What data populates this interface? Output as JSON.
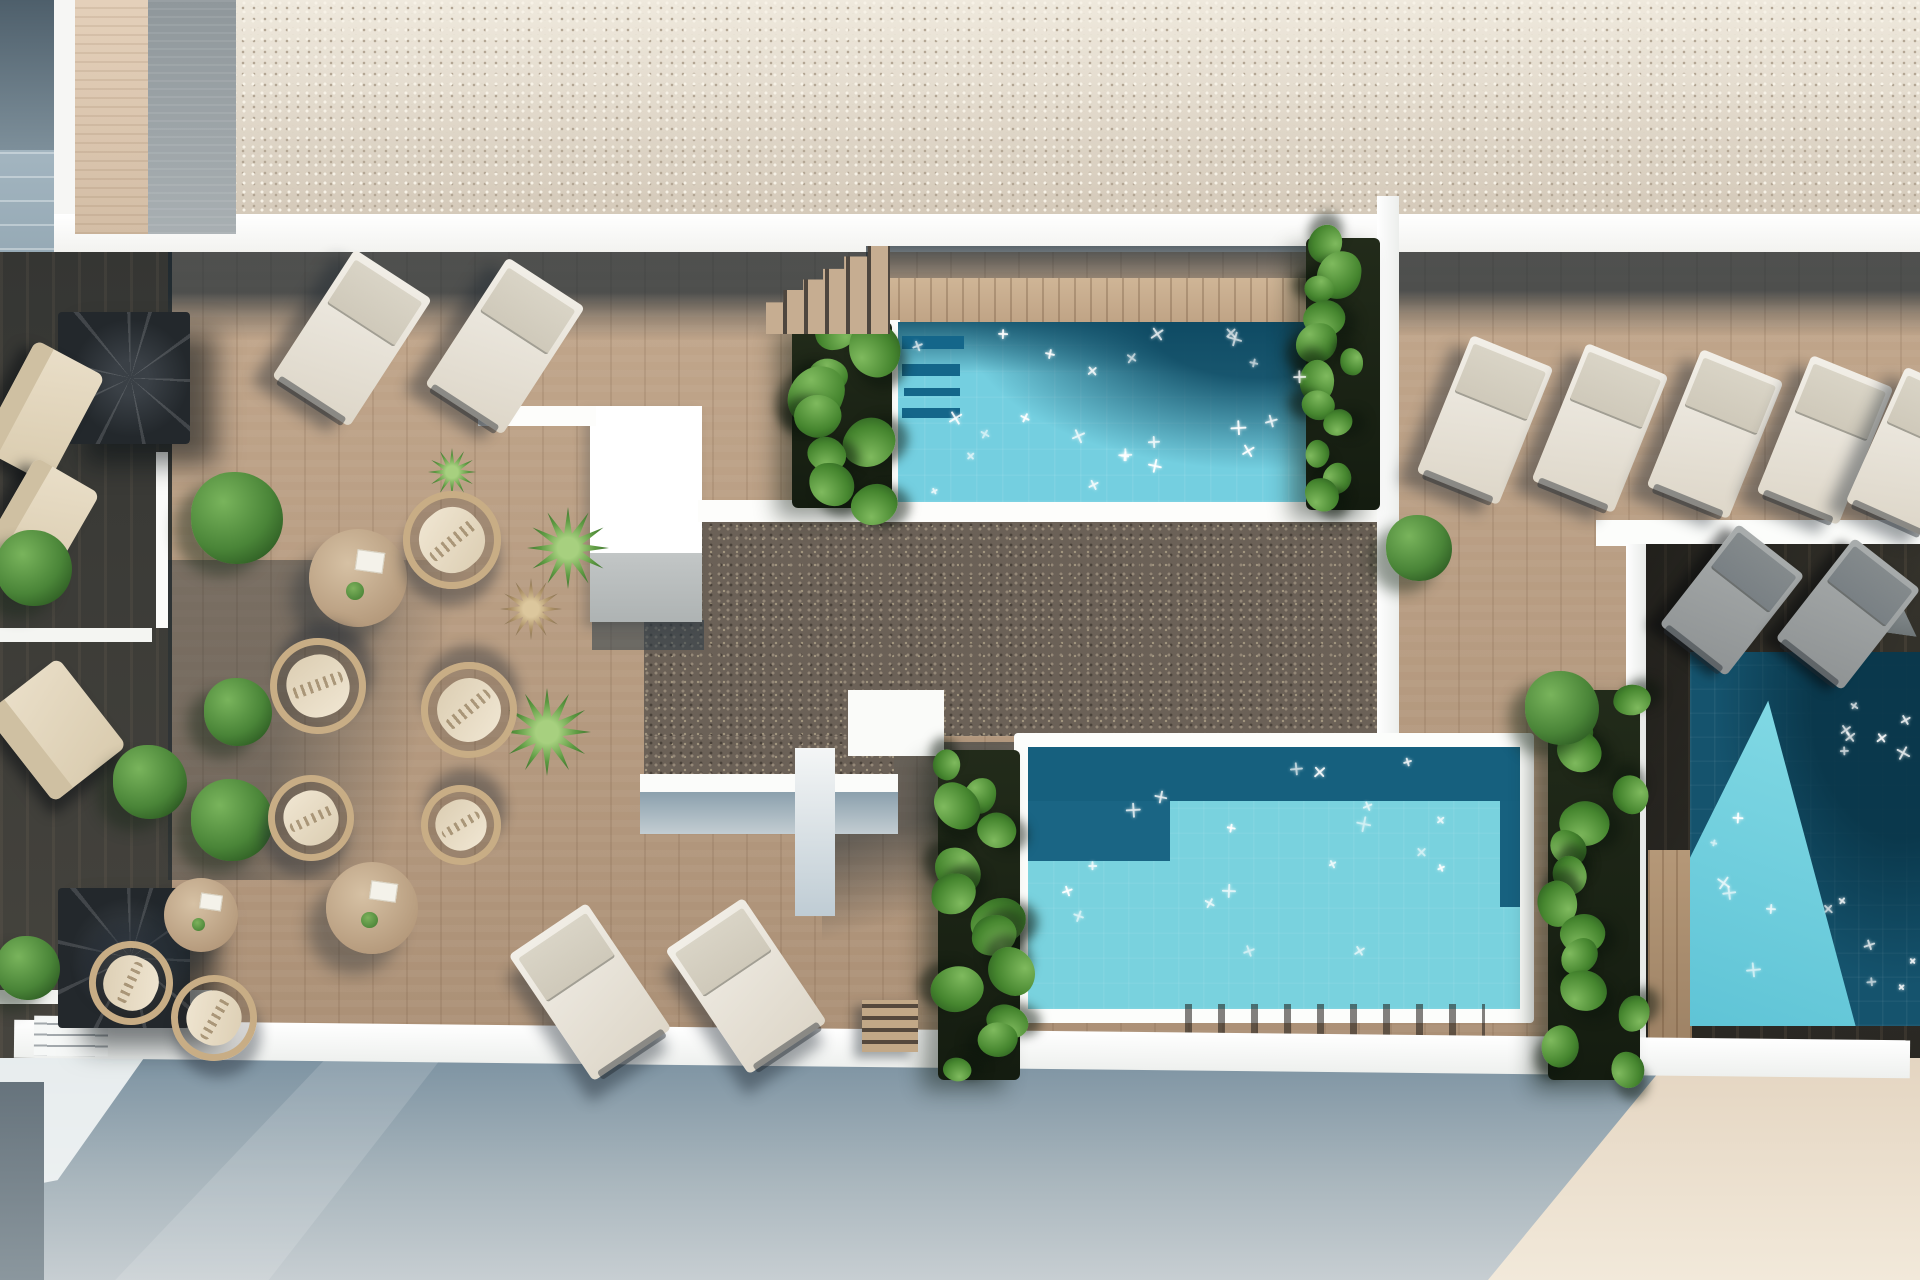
{
  "scene": {
    "description": "Aerial 3D architectural rendering of a rooftop terrace with three swimming pools, wooden decks, sun loungers, round lounge chairs, tables and planting",
    "width": 1920,
    "height": 1280
  },
  "palette": {
    "gravel_light": "#d9cfc1",
    "gravel_dark": "#6b6157",
    "deck_wood": "#b79b81",
    "deck_wood_lit": "#c9ae90",
    "deck_shadow": "#24333d",
    "dark_deck": "#312f29",
    "pool_light": "#74cfe0",
    "pool_mid_light": "#79d2de",
    "pool_dark": "#16607e",
    "pool_right_dark": "#15536d",
    "white_wall": "#ffffff",
    "facade_blue": "#7d93a2",
    "facade_beige": "#e4d5c1",
    "plant_green": "#46862f",
    "cushion": "#f0e6d2",
    "rattan": "#c8ad85"
  },
  "objects": {
    "sun_loungers_white": [
      {
        "x": 352,
        "y": 338,
        "w": 92,
        "l": 152,
        "rot": 33
      },
      {
        "x": 505,
        "y": 346,
        "w": 92,
        "l": 152,
        "rot": 33
      },
      {
        "x": 1485,
        "y": 420,
        "w": 88,
        "l": 148,
        "rot": 22
      },
      {
        "x": 1600,
        "y": 428,
        "w": 88,
        "l": 148,
        "rot": 22
      },
      {
        "x": 1715,
        "y": 434,
        "w": 88,
        "l": 148,
        "rot": 22
      },
      {
        "x": 1825,
        "y": 440,
        "w": 88,
        "l": 148,
        "rot": 22
      },
      {
        "x": 1916,
        "y": 452,
        "w": 88,
        "l": 148,
        "rot": 24
      },
      {
        "x": 590,
        "y": 992,
        "w": 94,
        "l": 152,
        "rot": -34
      },
      {
        "x": 746,
        "y": 986,
        "w": 94,
        "l": 150,
        "rot": -34
      }
    ],
    "sun_loungers_gray": [
      {
        "x": 1732,
        "y": 600,
        "w": 84,
        "l": 128,
        "rot": 38
      },
      {
        "x": 1848,
        "y": 614,
        "w": 84,
        "l": 128,
        "rot": 38
      }
    ],
    "ring_chairs": [
      {
        "x": 452,
        "y": 540,
        "d": 98,
        "rot": -40
      },
      {
        "x": 318,
        "y": 686,
        "d": 96,
        "rot": 160
      },
      {
        "x": 469,
        "y": 710,
        "d": 96,
        "rot": 140
      },
      {
        "x": 311,
        "y": 818,
        "d": 86,
        "rot": -25
      },
      {
        "x": 461,
        "y": 825,
        "d": 80,
        "rot": 150
      },
      {
        "x": 214,
        "y": 1018,
        "d": 86,
        "rot": -60
      },
      {
        "x": 131,
        "y": 983,
        "d": 84,
        "rot": 115
      }
    ],
    "round_tables": [
      {
        "x": 358,
        "y": 578,
        "d": 98
      },
      {
        "x": 372,
        "y": 908,
        "d": 92
      },
      {
        "x": 201,
        "y": 915,
        "d": 74
      }
    ],
    "sofas": [
      {
        "x": 42,
        "y": 412,
        "w": 78,
        "h": 122,
        "rot": 28
      },
      {
        "x": 40,
        "y": 524,
        "w": 74,
        "h": 112,
        "rot": 30
      },
      {
        "x": 56,
        "y": 730,
        "w": 92,
        "h": 112,
        "rot": -38
      }
    ],
    "bushes": [
      {
        "x": 237,
        "y": 518,
        "d": 92
      },
      {
        "x": 238,
        "y": 712,
        "d": 68
      },
      {
        "x": 150,
        "y": 782,
        "d": 74
      },
      {
        "x": 232,
        "y": 820,
        "d": 82
      },
      {
        "x": 34,
        "y": 568,
        "d": 76
      },
      {
        "x": 28,
        "y": 968,
        "d": 64
      },
      {
        "x": 1419,
        "y": 548,
        "d": 66
      },
      {
        "x": 1562,
        "y": 708,
        "d": 74
      }
    ],
    "palms": [
      {
        "x": 568,
        "y": 548,
        "d": 82,
        "variant": "green"
      },
      {
        "x": 547,
        "y": 732,
        "d": 88,
        "variant": "green"
      },
      {
        "x": 531,
        "y": 609,
        "d": 62,
        "variant": "dry"
      },
      {
        "x": 452,
        "y": 472,
        "d": 48,
        "variant": "green"
      }
    ],
    "spiral_stairs": [
      {
        "x": 124,
        "y": 378,
        "w": 132,
        "h": 132
      },
      {
        "x": 124,
        "y": 958,
        "w": 132,
        "h": 140
      }
    ],
    "wood_stairs": [
      {
        "x": 828,
        "y": 290,
        "w": 124,
        "h": 88
      }
    ],
    "wood_steps_small": [
      {
        "x": 890,
        "y": 1026,
        "w": 56,
        "h": 52
      }
    ],
    "gray_wedges": [
      {
        "x": 1884,
        "y": 604,
        "w": 74,
        "h": 56,
        "rot": 8
      }
    ],
    "vine_columns": [
      {
        "x": 792,
        "y": 322,
        "w": 100,
        "h": 186,
        "leaves": 9,
        "leaf_min": 34,
        "leaf_max": 56,
        "seed": 21
      },
      {
        "x": 1306,
        "y": 238,
        "w": 74,
        "h": 272,
        "leaves": 12,
        "leaf_min": 26,
        "leaf_max": 46,
        "seed": 22
      },
      {
        "x": 938,
        "y": 750,
        "w": 82,
        "h": 330,
        "leaves": 13,
        "leaf_min": 28,
        "leaf_max": 48,
        "seed": 23
      },
      {
        "x": 1548,
        "y": 690,
        "w": 92,
        "h": 390,
        "leaves": 14,
        "leaf_min": 30,
        "leaf_max": 50,
        "seed": 24
      }
    ],
    "pool_sparkles": [
      {
        "x": 910,
        "y": 332,
        "w": 392,
        "h": 162,
        "count": 24,
        "seed": 7
      },
      {
        "x": 1045,
        "y": 806,
        "w": 460,
        "h": 192,
        "count": 15,
        "seed": 8
      },
      {
        "x": 1050,
        "y": 756,
        "w": 420,
        "h": 44,
        "count": 4,
        "seed": 9
      },
      {
        "x": 1700,
        "y": 800,
        "w": 185,
        "h": 210,
        "count": 9,
        "seed": 10
      },
      {
        "x": 1840,
        "y": 680,
        "w": 78,
        "h": 95,
        "count": 7,
        "seed": 11
      },
      {
        "x": 1868,
        "y": 935,
        "w": 48,
        "h": 80,
        "count": 3,
        "seed": 12
      }
    ]
  }
}
